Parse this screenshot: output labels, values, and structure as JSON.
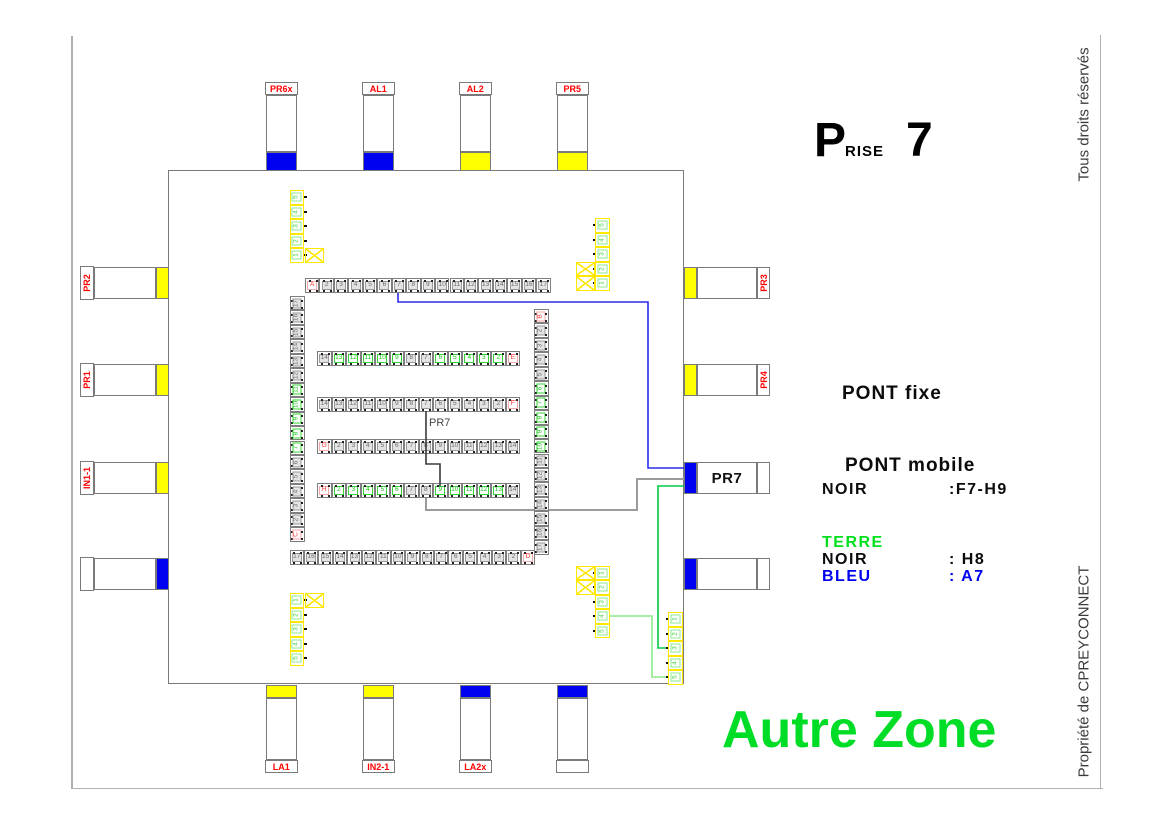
{
  "page": {
    "title": {
      "big_p": "P",
      "rise": "RISE",
      "number": "7"
    },
    "vertical_top_right": "Tous droits réservés",
    "vertical_bottom_right": "Propriété de CPREYCONNECT",
    "zone_label": "Autre Zone"
  },
  "legend": {
    "pont_fixe": "PONT fixe",
    "pont_mobile": "PONT mobile",
    "pont_mobile_color_label": "NOIR",
    "pont_mobile_value": ":F7-H9",
    "terre": "TERRE",
    "terre_noir_label": "NOIR",
    "terre_noir_value": ": H8",
    "terre_bleu_label": "BLEU",
    "terre_bleu_value": ": A7"
  },
  "inner_wire_label": "PR7",
  "colors": {
    "yellow": "#ffff00",
    "blue": "#0000f0",
    "red_label": "#ff0000",
    "terre_green": "#00e01e",
    "zone_green": "#00dd26",
    "wire_blue": "#2a2af0",
    "wire_black": "#3a3a3a",
    "wire_grey": "#9b9b9b",
    "wire_green_dark": "#00cc44",
    "wire_green_light": "#8ae98a"
  },
  "connectors": {
    "top": [
      {
        "label": "PR6x",
        "color": "blue"
      },
      {
        "label": "AL1",
        "color": "blue"
      },
      {
        "label": "AL2",
        "color": "yellow"
      },
      {
        "label": "PR5",
        "color": "yellow"
      }
    ],
    "left": [
      {
        "label": "PR2",
        "color": "yellow"
      },
      {
        "label": "PR1",
        "color": "yellow"
      },
      {
        "label": "IN1-1",
        "color": "yellow"
      },
      {
        "label": "",
        "color": "blue"
      }
    ],
    "right": [
      {
        "label": "PR3",
        "color": "yellow"
      },
      {
        "label": "PR4",
        "color": "yellow"
      },
      {
        "label": "PR7",
        "color": "blue",
        "big": true
      },
      {
        "label": "",
        "color": "blue"
      }
    ],
    "bottom": [
      {
        "label": "LA1",
        "color": "yellow"
      },
      {
        "label": "IN2-1",
        "color": "yellow"
      },
      {
        "label": "LA2x",
        "color": "blue"
      },
      {
        "label": "",
        "color": "blue"
      }
    ]
  },
  "terminals": {
    "top_row": [
      [
        "A",
        "r"
      ],
      [
        "2",
        "g"
      ],
      [
        "3",
        "g"
      ],
      [
        "4",
        "g"
      ],
      [
        "5",
        "g"
      ],
      [
        "6",
        "g"
      ],
      [
        "7",
        "g"
      ],
      [
        "8",
        "g"
      ],
      [
        "9",
        "g"
      ],
      [
        "10",
        "g"
      ],
      [
        "11",
        "g"
      ],
      [
        "12",
        "g"
      ],
      [
        "13",
        "g"
      ],
      [
        "14",
        "g"
      ],
      [
        "15",
        "g"
      ],
      [
        "16",
        "g"
      ],
      [
        "17",
        "g"
      ]
    ],
    "left_col": [
      [
        "17",
        "g"
      ],
      [
        "16",
        "g"
      ],
      [
        "15",
        "g"
      ],
      [
        "14",
        "g"
      ],
      [
        "13",
        "g"
      ],
      [
        "12",
        "g"
      ],
      [
        "11",
        "n"
      ],
      [
        "10",
        "n"
      ],
      [
        "9",
        "n"
      ],
      [
        "8",
        "n"
      ],
      [
        "7",
        "n"
      ],
      [
        "6",
        "g"
      ],
      [
        "5",
        "g"
      ],
      [
        "4",
        "g"
      ],
      [
        "3",
        "g"
      ],
      [
        "2",
        "g"
      ],
      [
        "C",
        "r"
      ]
    ],
    "right_col": [
      [
        "B",
        "r"
      ],
      [
        "2",
        "g"
      ],
      [
        "3",
        "g"
      ],
      [
        "4",
        "g"
      ],
      [
        "5",
        "g"
      ],
      [
        "6",
        "n"
      ],
      [
        "7",
        "n"
      ],
      [
        "8",
        "n"
      ],
      [
        "9",
        "n"
      ],
      [
        "10",
        "n"
      ],
      [
        "11",
        "g"
      ],
      [
        "12",
        "g"
      ],
      [
        "13",
        "g"
      ],
      [
        "14",
        "g"
      ],
      [
        "15",
        "g"
      ],
      [
        "16",
        "g"
      ],
      [
        "17",
        "g"
      ]
    ],
    "bottom_row": [
      [
        "17",
        "g"
      ],
      [
        "16",
        "g"
      ],
      [
        "15",
        "g"
      ],
      [
        "14",
        "g"
      ],
      [
        "13",
        "g"
      ],
      [
        "12",
        "g"
      ],
      [
        "11",
        "g"
      ],
      [
        "10",
        "g"
      ],
      [
        "9",
        "g"
      ],
      [
        "8",
        "g"
      ],
      [
        "7",
        "g"
      ],
      [
        "6",
        "g"
      ],
      [
        "5",
        "g"
      ],
      [
        "4",
        "g"
      ],
      [
        "3",
        "g"
      ],
      [
        "2",
        "g"
      ],
      [
        "D",
        "r"
      ]
    ],
    "row_e": [
      [
        "14",
        "g"
      ],
      [
        "13",
        "n"
      ],
      [
        "12",
        "n"
      ],
      [
        "11",
        "n"
      ],
      [
        "10",
        "n"
      ],
      [
        "9",
        "n"
      ],
      [
        "8",
        "g"
      ],
      [
        "7",
        "g"
      ],
      [
        "6",
        "n"
      ],
      [
        "5",
        "n"
      ],
      [
        "4",
        "n"
      ],
      [
        "3",
        "n"
      ],
      [
        "2",
        "n"
      ],
      [
        "E",
        "r"
      ]
    ],
    "row_f": [
      [
        "14",
        "g"
      ],
      [
        "13",
        "g"
      ],
      [
        "12",
        "g"
      ],
      [
        "11",
        "g"
      ],
      [
        "10",
        "g"
      ],
      [
        "9",
        "g"
      ],
      [
        "8",
        "g"
      ],
      [
        "7",
        "g"
      ],
      [
        "6",
        "g"
      ],
      [
        "5",
        "g"
      ],
      [
        "4",
        "g"
      ],
      [
        "3",
        "g"
      ],
      [
        "2",
        "g"
      ],
      [
        "F",
        "r"
      ]
    ],
    "row_g": [
      [
        "G",
        "r"
      ],
      [
        "2",
        "g"
      ],
      [
        "3",
        "g"
      ],
      [
        "4",
        "g"
      ],
      [
        "5",
        "g"
      ],
      [
        "6",
        "g"
      ],
      [
        "7",
        "g"
      ],
      [
        "8",
        "g"
      ],
      [
        "9",
        "g"
      ],
      [
        "10",
        "g"
      ],
      [
        "11",
        "g"
      ],
      [
        "12",
        "g"
      ],
      [
        "13",
        "g"
      ],
      [
        "14",
        "g"
      ]
    ],
    "row_h": [
      [
        "H",
        "r"
      ],
      [
        "2",
        "n"
      ],
      [
        "3",
        "n"
      ],
      [
        "4",
        "n"
      ],
      [
        "5",
        "n"
      ],
      [
        "6",
        "n"
      ],
      [
        "7",
        "g"
      ],
      [
        "8",
        "g"
      ],
      [
        "9",
        "n"
      ],
      [
        "10",
        "n"
      ],
      [
        "11",
        "n"
      ],
      [
        "12",
        "n"
      ],
      [
        "13",
        "n"
      ],
      [
        "14",
        "g"
      ]
    ]
  },
  "earth_groups": {
    "top_left": {
      "cells": [
        "5",
        "4",
        "3",
        "2",
        "1"
      ]
    },
    "top_right": {
      "cells": [
        "5",
        "4",
        "3",
        "2",
        "1"
      ]
    },
    "bottom_left": {
      "cells": [
        "1",
        "2",
        "3",
        "4",
        "5"
      ]
    },
    "bottom_right_a": {
      "cells": [
        "1",
        "2",
        "3",
        "4",
        "5"
      ]
    },
    "bottom_right_b": {
      "cells": [
        "1",
        "2",
        "3",
        "4",
        "5"
      ]
    }
  },
  "wires": {
    "blue_a7": {
      "color_key": "wire_blue",
      "points": "398,293 398,302 648,302 648,468 686,468"
    },
    "grey_h8": {
      "color_key": "wire_grey",
      "points": "426,497 426,510 637,510 637,479 686,479"
    },
    "green_terre_a": {
      "color_key": "wire_green_dark",
      "points": "686,486 658,486 658,648 667,648"
    },
    "green_terre_b": {
      "color_key": "wire_green_light",
      "points": "609,616 652,616 652,677 667,677"
    },
    "black_bridge": {
      "color_key": "wire_black",
      "points": "426,411 426,464 440,464 440,486"
    }
  }
}
